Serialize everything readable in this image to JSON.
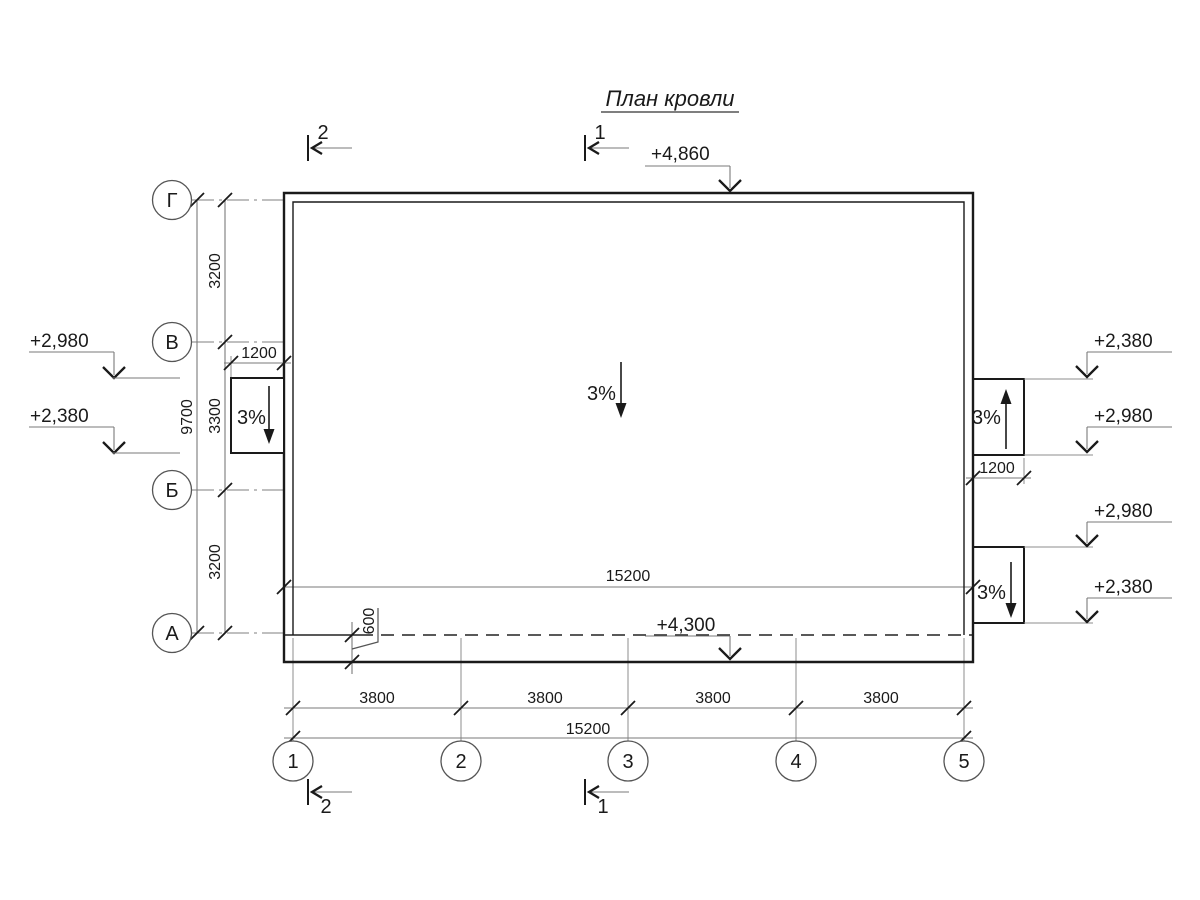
{
  "title": "План кровли",
  "colors": {
    "line": "#1a1a1a",
    "dim_line": "#7a7a7a",
    "background": "#ffffff"
  },
  "grid": {
    "row_axes": [
      "Г",
      "В",
      "Б",
      "А"
    ],
    "column_axes": [
      "1",
      "2",
      "3",
      "4",
      "5"
    ]
  },
  "section_marks": {
    "top_left": "2",
    "top_center": "1",
    "bottom_left": "2",
    "bottom_center": "1"
  },
  "elevation_marks": {
    "roof_top": "+4,860",
    "roof_bottom": "+4,300",
    "left": [
      "+2,980",
      "+2,380"
    ],
    "right": [
      "+2,380",
      "+2,980",
      "+2,980",
      "+2,380"
    ]
  },
  "slopes": {
    "left_canopy": "3%",
    "roof": "3%",
    "right_upper_canopy": "3%",
    "right_lower_canopy": "3%"
  },
  "dimensions": {
    "left_segments": [
      "3200",
      "3300",
      "3200"
    ],
    "left_total": "9700",
    "left_canopy_width": "1200",
    "right_canopy_width": "1200",
    "roof_width": "15200",
    "eave_overhang": "600",
    "bottom_bays": [
      "3800",
      "3800",
      "3800",
      "3800"
    ],
    "bottom_total": "15200"
  }
}
